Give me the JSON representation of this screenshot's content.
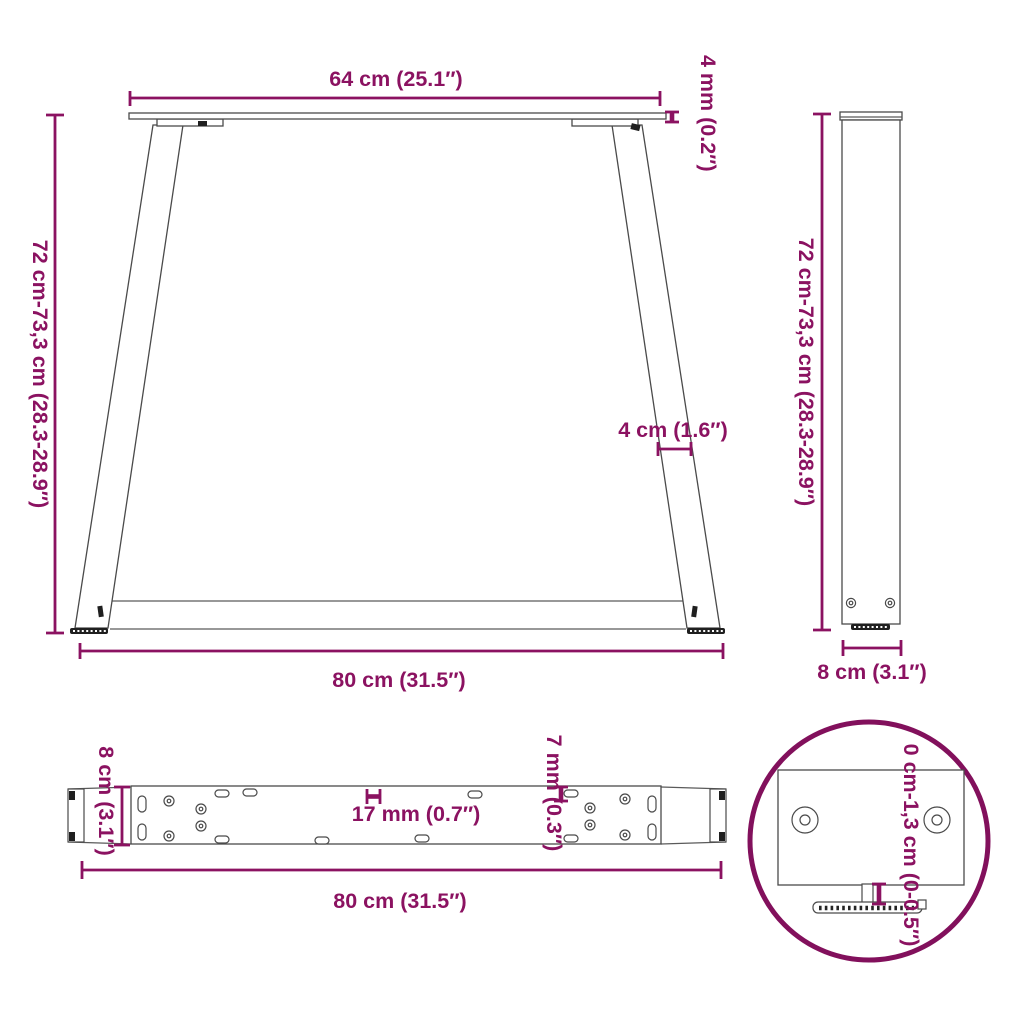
{
  "diagram_title": "table-legs-dimension-diagram",
  "colors": {
    "dimension_accent": "#8B1261",
    "detail_circle": "#82105C",
    "line_art": "#4a4a4a",
    "dark_parts": "#1f1f1f",
    "background": "#ffffff"
  },
  "views": {
    "front": {
      "labels": {
        "top_width": "64 cm (25.1″)",
        "top_bar_thickness": "4 mm (0.2″)",
        "height_range": "72 cm-73,3 cm (28.3-28.9″)",
        "leg_profile_width": "4 cm (1.6″)",
        "bottom_width": "80 cm (31.5″)"
      }
    },
    "side": {
      "labels": {
        "height_range": "72 cm-73,3 cm (28.3-28.9″)",
        "depth": "8 cm (3.1″)"
      }
    },
    "top": {
      "labels": {
        "depth": "8 cm (3.1″)",
        "slot_spacing": "17 mm (0.7″)",
        "hole_diameter": "7 mm (0.3″)",
        "length": "80 cm (31.5″)"
      }
    },
    "foot_detail": {
      "labels": {
        "adjustable_range": "0 cm-1,3 cm (0-0.5″)"
      }
    }
  }
}
